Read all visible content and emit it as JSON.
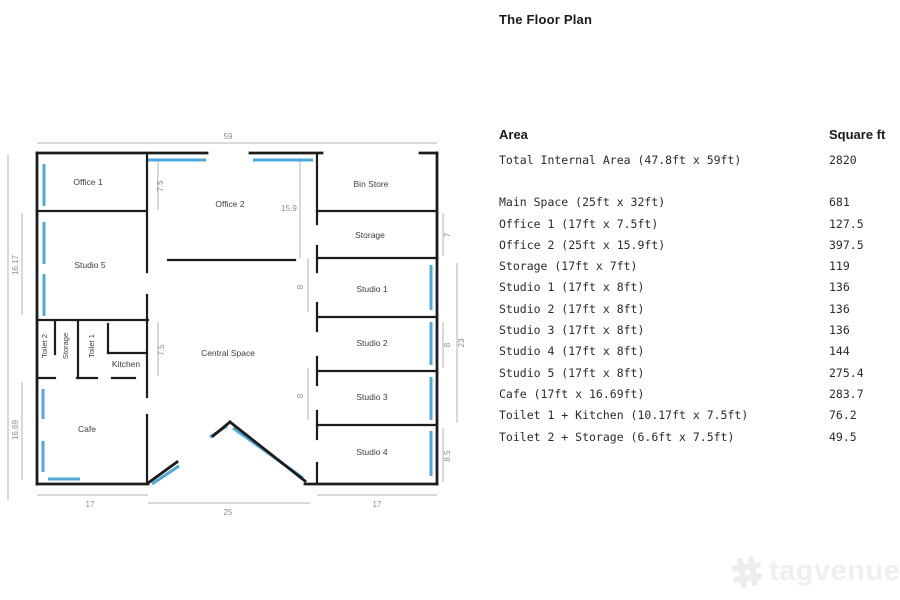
{
  "title": "The Floor Plan",
  "table": {
    "header": {
      "area": "Area",
      "sqft": "Square ft"
    },
    "rows": [
      {
        "area": "Total Internal Area (47.8ft x 59ft)",
        "sqft": "2820"
      },
      {
        "area": "Main Space (25ft x 32ft)",
        "sqft": "681"
      },
      {
        "area": "Office 1 (17ft x 7.5ft)",
        "sqft": "127.5"
      },
      {
        "area": "Office 2 (25ft x 15.9ft)",
        "sqft": "397.5"
      },
      {
        "area": "Storage (17ft x 7ft)",
        "sqft": "119"
      },
      {
        "area": "Studio 1 (17ft x 8ft)",
        "sqft": "136"
      },
      {
        "area": "Studio 2 (17ft x 8ft)",
        "sqft": "136"
      },
      {
        "area": "Studio 3 (17ft x 8ft)",
        "sqft": "136"
      },
      {
        "area": "Studio 4 (17ft x 8ft)",
        "sqft": "144"
      },
      {
        "area": "Studio 5 (17ft x 8ft)",
        "sqft": "275.4"
      },
      {
        "area": "Cafe (17ft x 16.69ft)",
        "sqft": "283.7"
      },
      {
        "area": "Toilet 1 + Kitchen (10.17ft x 7.5ft)",
        "sqft": "76.2"
      },
      {
        "area": "Toilet 2 + Storage (6.6ft x 7.5ft)",
        "sqft": "49.5"
      }
    ]
  },
  "plan": {
    "rooms": {
      "office1": "Office 1",
      "office2": "Office 2",
      "bin_store": "Bin Store",
      "storage_top": "Storage",
      "studio1": "Studio 1",
      "studio2": "Studio 2",
      "studio3": "Studio 3",
      "studio4": "Studio 4",
      "studio5": "Studio 5",
      "central": "Central Space",
      "cafe": "Cafe",
      "toilet2": "Toilet 2",
      "storage_strip": "Storage",
      "toilet1": "Toilet 1",
      "kitchen": "Kitchen"
    },
    "dims": {
      "top_width": "59",
      "office1_h": "7.5",
      "office2_h": "15.9",
      "storage_h": "7",
      "studios_h": "23",
      "studio2_h": "8",
      "studio4_h": "8.5",
      "studio1_door": "8",
      "studio3_door": "8",
      "kitchen_h": "7.5",
      "studio5_h": "16.17",
      "cafe_h": "16.69",
      "cafe_w": "17",
      "main_w": "25",
      "studio_w": "17"
    },
    "colors": {
      "wall": "#1c1c1c",
      "window": "#4fa8dc",
      "dim": "#b3b3b3"
    }
  },
  "watermark": {
    "text": "tagvenue"
  }
}
